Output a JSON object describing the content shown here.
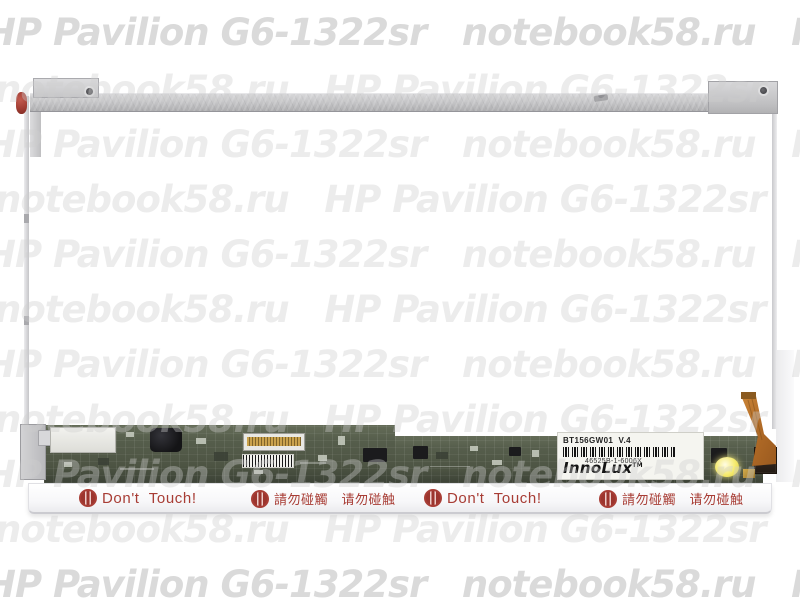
{
  "watermark": {
    "rows": [
      {
        "text": "HP Pavilion G6-1322sr   notebook58.ru   HP Pavilion"
      },
      {
        "text": "notebook58.ru   HP Pavilion G6-1322sr   notebook58.ru"
      },
      {
        "text": "HP Pavilion G6-1322sr   notebook58.ru   HP Pavilion"
      },
      {
        "text": "notebook58.ru   HP Pavilion G6-1322sr   notebook58.ru"
      },
      {
        "text": "HP Pavilion G6-1322sr   notebook58.ru   HP Pavilion"
      },
      {
        "text": "notebook58.ru   HP Pavilion G6-1322sr   notebook58.ru"
      },
      {
        "text": "HP Pavilion G6-1322sr   notebook58.ru   HP Pavilion"
      },
      {
        "text": "notebook58.ru   HP Pavilion G6-1322sr   notebook58.ru"
      },
      {
        "text": "HP Pavilion G6-1322sr   notebook58.ru   HP Pavilion"
      },
      {
        "text": "notebook58.ru   HP Pavilion G6-1322sr   notebook58.ru"
      },
      {
        "text": "HP Pavilion G6-1322sr   notebook58.ru   HP Pavilion"
      }
    ]
  },
  "panel": {
    "label": {
      "model": "BT156GW01  V.4",
      "serial": "46525B-1-6006X",
      "brand": "InnoLux",
      "trademark": "TM"
    }
  },
  "warnings": {
    "english": "Don't  Touch!",
    "chinese": "請勿碰觸　请勿碰触"
  },
  "colors": {
    "pcb_green": "#565e4c",
    "warning_red": "#a83d35",
    "cable_orange": "#c07a30",
    "metal_gray": "#c6c6c8",
    "led_yellow": "#f5ea6e"
  }
}
